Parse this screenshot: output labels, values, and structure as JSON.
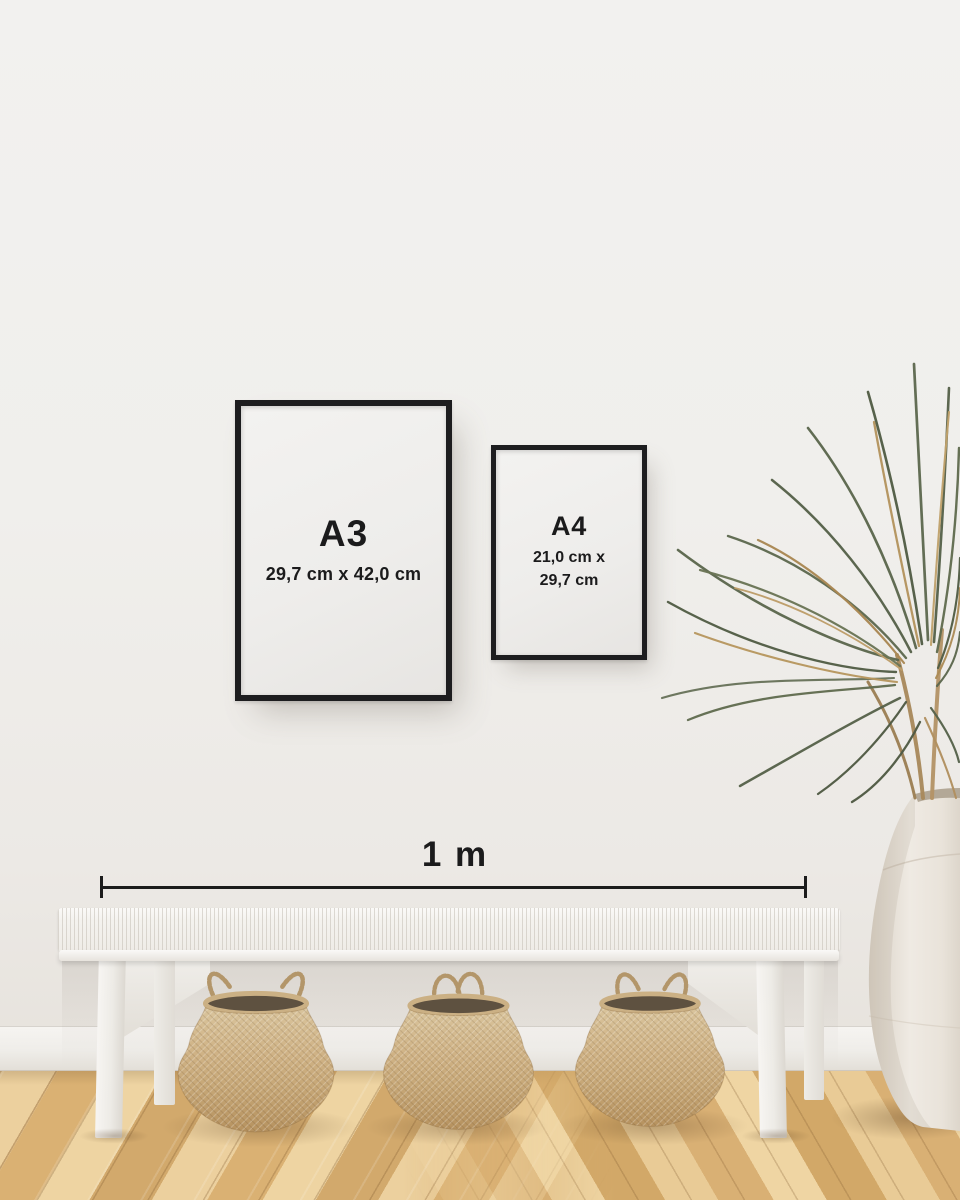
{
  "posters": [
    {
      "label": "A3",
      "size_lines": [
        "29,7 cm x 42,0 cm"
      ]
    },
    {
      "label": "A4",
      "size_lines": [
        "21,0 cm x",
        "29,7 cm"
      ]
    }
  ],
  "scale_bar": {
    "label": "1 m"
  },
  "colors": {
    "wall": "#f0efed",
    "frame_black": "#1d1d1f",
    "poster_paper": "#eeedeb",
    "text_dark": "#1b1b1c",
    "scale_line": "#1c1c1c",
    "bench_white": "#efece7",
    "basket_light": "#d9c49c",
    "basket_dark": "#b6925f",
    "basket_opening": "#5e5140",
    "floor_light": "#ecd09e",
    "floor_dark": "#d2a96c",
    "vase_white": "#ece7e0",
    "leaf_green": "#5c674d",
    "leaf_dried": "#b4945e"
  }
}
